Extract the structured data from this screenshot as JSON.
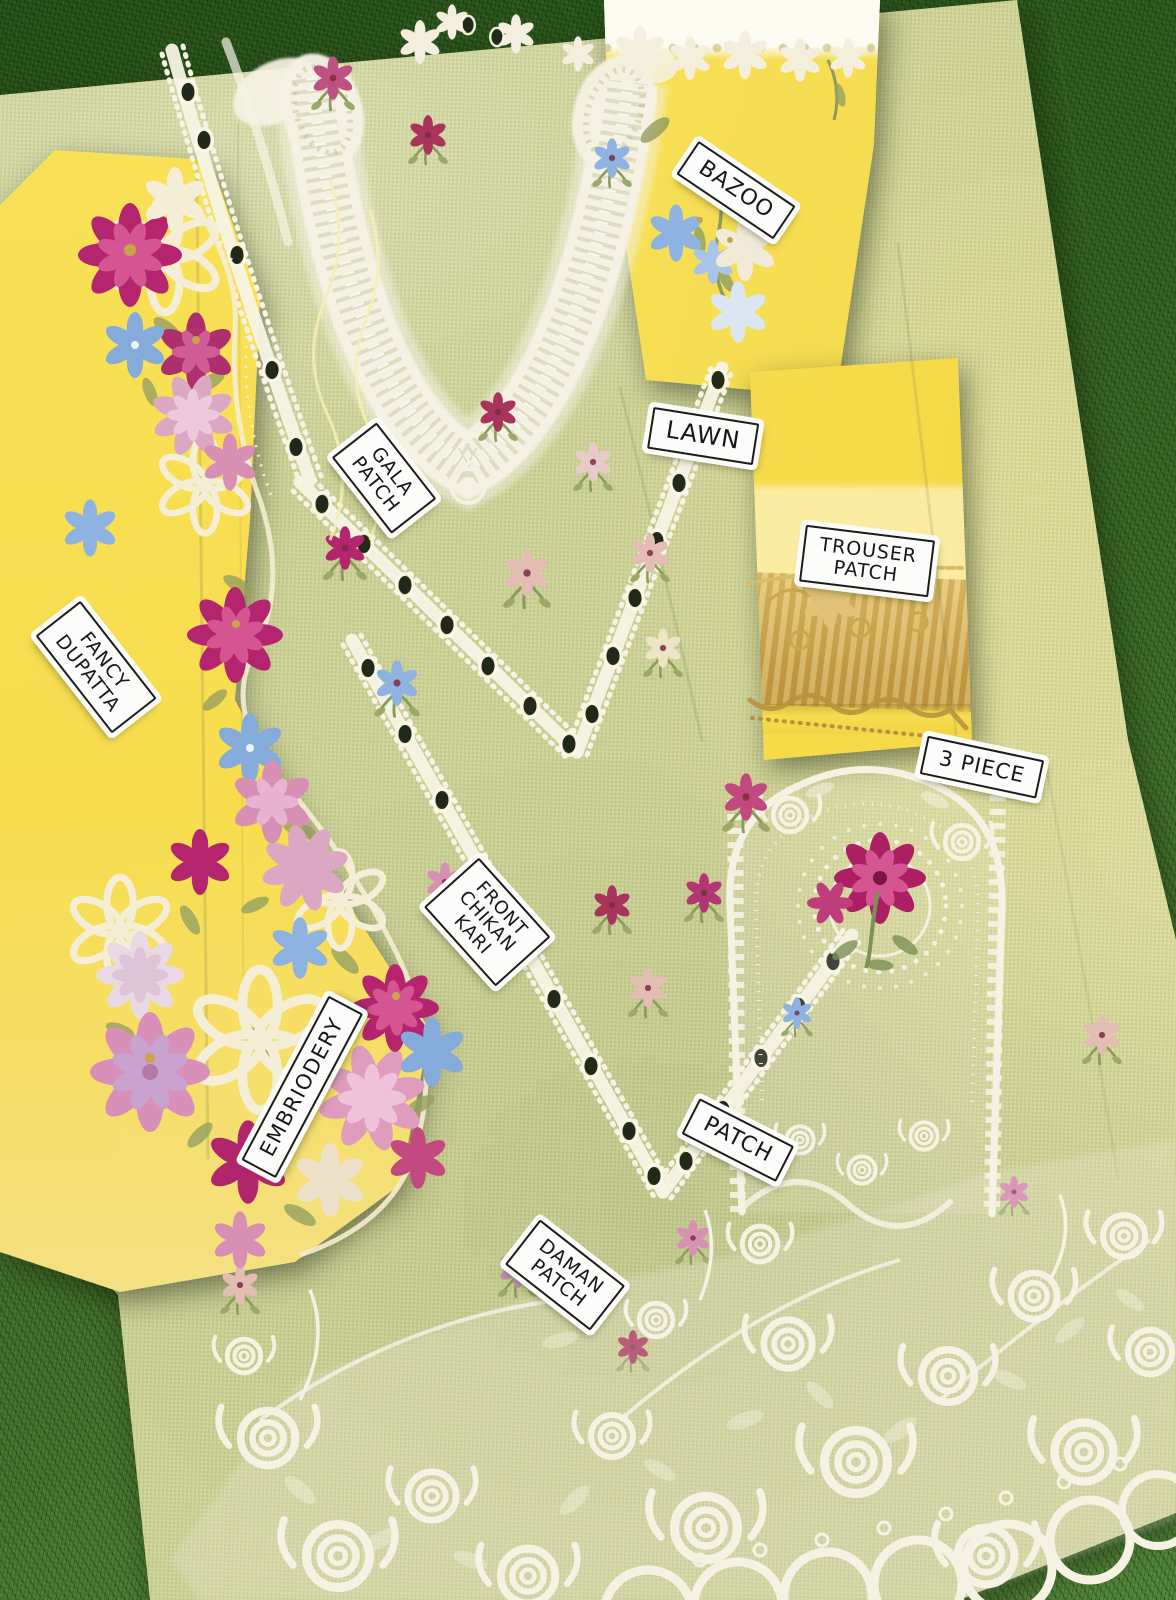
{
  "photo": {
    "subject_tags": {
      "bazoo": {
        "lines": [
          "BAZOO"
        ]
      },
      "lawn": {
        "lines": [
          "LAWN"
        ]
      },
      "gala_patch": {
        "lines": [
          "GALA",
          "PATCH"
        ]
      },
      "fancy_dupatta": {
        "lines": [
          "FANCY",
          "DUPATTA"
        ]
      },
      "trouser_patch": {
        "lines": [
          "TROUSER",
          "PATCH"
        ]
      },
      "three_piece": {
        "lines": [
          "3 PIECE"
        ]
      },
      "front_chikan_kari": {
        "lines": [
          "FRONT",
          "CHIKAN",
          "KARI"
        ]
      },
      "embroidery": {
        "lines": [
          "EMBRIODERY"
        ]
      },
      "patch": {
        "lines": [
          "PATCH"
        ]
      },
      "daman_patch": {
        "lines": [
          "DAMAN",
          "PATCH"
        ]
      }
    },
    "colors": {
      "grass_dark": "#2e5c1d",
      "grass_light": "#4e7f35",
      "lawn_fabric": "#cbd092",
      "dupatta_yellow": "#f7dd4e",
      "embroidery_white": "#f6f2e3",
      "gold_lace": "#c9a84c",
      "magenta": "#b5246e",
      "pink": "#d78fb4",
      "blue": "#8fb3e0",
      "button_dark": "#232918",
      "tag_background": "#fcfcfa",
      "tag_text": "#161616"
    }
  }
}
